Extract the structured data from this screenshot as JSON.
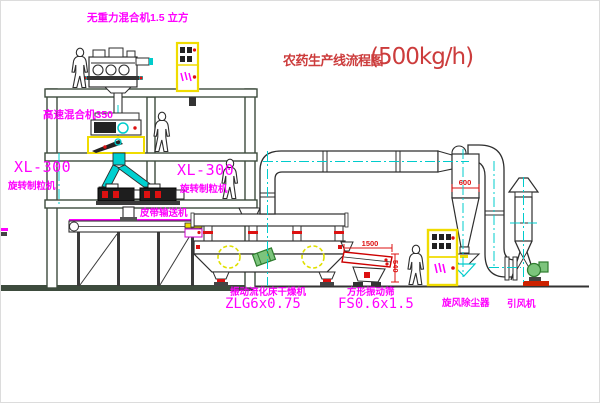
{
  "title": {
    "name": "农药生产线流程图",
    "capacity": "(500kg/h)"
  },
  "equipment_labels": {
    "gravity_mixer": "无重力混合机1.5 立方",
    "high_speed_mixer": "高速混合机350",
    "granulator_model_left": "XL-300",
    "granulator_name_left": "旋转制粒机",
    "granulator_model_right": "XL-300",
    "granulator_name_right": "旋转制粒机",
    "belt_conveyor": "皮带输送机",
    "dryer_name": "振动流化床干燥机",
    "dryer_model": "ZLG6x0.75",
    "sieve_name": "方形振动筛",
    "sieve_model": "FS0.6x1.5",
    "cyclone": "旋风除尘器",
    "induced_draft_fan": "引风机"
  },
  "dimensions": {
    "cyclone_width": "600",
    "sieve_length": "1500",
    "sieve_height": "540"
  },
  "colors": {
    "label_magenta": "#ff00ff",
    "title_red": "#cc3c3c",
    "dimension_red": "#dd1111",
    "centerline_cyan": "#00cccc",
    "cabinet_yellow": "#f0dc00",
    "structure_green": "#3d4b3d",
    "fan_green": "#7cc47c"
  }
}
